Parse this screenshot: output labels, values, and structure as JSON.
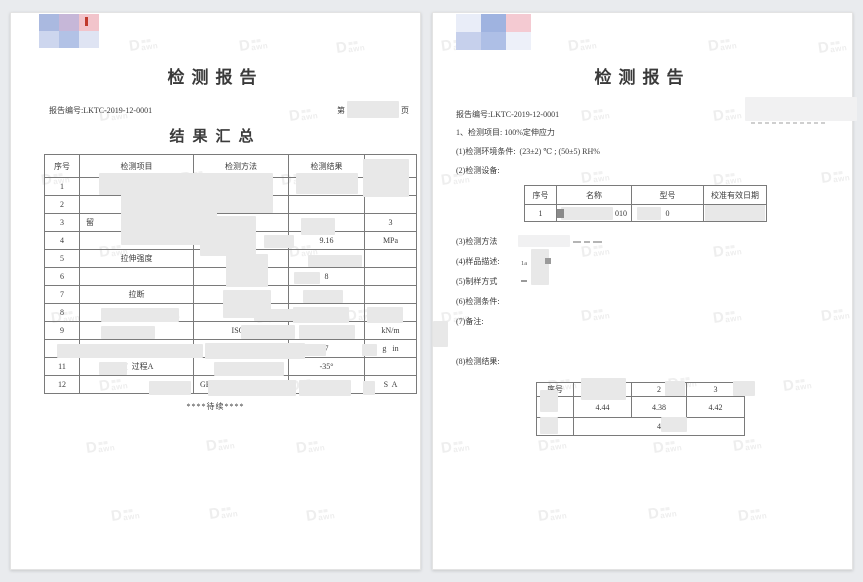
{
  "watermark": {
    "big": "D",
    "text": "awn"
  },
  "pages": {
    "left": {
      "title": "检测报告",
      "report_no": "报告编号:LKTC-2019-12-0001",
      "page_label_prefix": "第",
      "page_label_suffix": "页",
      "section_title": "结果汇总",
      "summary_table": {
        "headers": [
          "序号",
          "检测项目",
          "检测方法",
          "检测结果",
          "检测单"
        ],
        "rows": [
          {
            "no": "1",
            "item": "",
            "method": "",
            "result": "",
            "unit": ""
          },
          {
            "no": "2",
            "item": "伸应力",
            "method": "",
            "result": "",
            "unit": ""
          },
          {
            "no": "3",
            "item": "留",
            "method": "",
            "result": "",
            "unit": "3"
          },
          {
            "no": "4",
            "item": "",
            "method": "ISO 37:2",
            "result": "9.16",
            "unit": "MPa"
          },
          {
            "no": "5",
            "item": "拉伸强度",
            "method": "",
            "result": "",
            "unit": ""
          },
          {
            "no": "6",
            "item": "",
            "method": "37:2011",
            "result": "8",
            "unit": ""
          },
          {
            "no": "7",
            "item": "拉断",
            "method": "37:2",
            "result": "1",
            "unit": ""
          },
          {
            "no": "8",
            "item": "撕   度",
            "method": "I         )",
            "result": "",
            "unit": ""
          },
          {
            "no": "9",
            "item": "度",
            "method": "ISO 3",
            "result": "",
            "unit": "kN/m"
          },
          {
            "no": "10",
            "item": "",
            "method": "",
            "result": "7",
            "unit": "g   in"
          },
          {
            "no": "11",
            "item": "度  过程A",
            "method": "",
            "result": "-35°",
            "unit": ""
          },
          {
            "no": "12",
            "item": "",
            "method": "GB         )",
            "result": "",
            "unit": "S  A"
          }
        ]
      },
      "footer": "****待续****"
    },
    "right": {
      "title": "检测报告",
      "report_no": "报告编号:LKTC-2019-12-0001",
      "item_line": "1、检测项目: 100%定伸应力",
      "env_line": "(1)检测环境条件:  (23±2) ℃ ; (50±5) RH%",
      "equip_label": "(2)检测设备:",
      "equipment_table": {
        "headers": [
          "序号",
          "名称",
          "型号",
          "校准有效日期"
        ],
        "row": {
          "no": "1",
          "name": "010",
          "model": "0",
          "calibration": ""
        }
      },
      "method_line": "(3)检测方法",
      "sample_line": "(4)样品描述:",
      "sample_fragment": "1a",
      "prep_line": "(5)制样方式",
      "condition_line": "(6)检测条件:",
      "remark_line": "(7)备注:",
      "result_label": "(8)检测结果:",
      "result_table": {
        "headers": [
          "序号",
          "1",
          "2",
          "3"
        ],
        "row1": {
          "label": "测",
          "values": [
            "4.44",
            "4.38",
            "4.42"
          ]
        },
        "row2": {
          "label": "结",
          "value": "4"
        }
      }
    }
  }
}
